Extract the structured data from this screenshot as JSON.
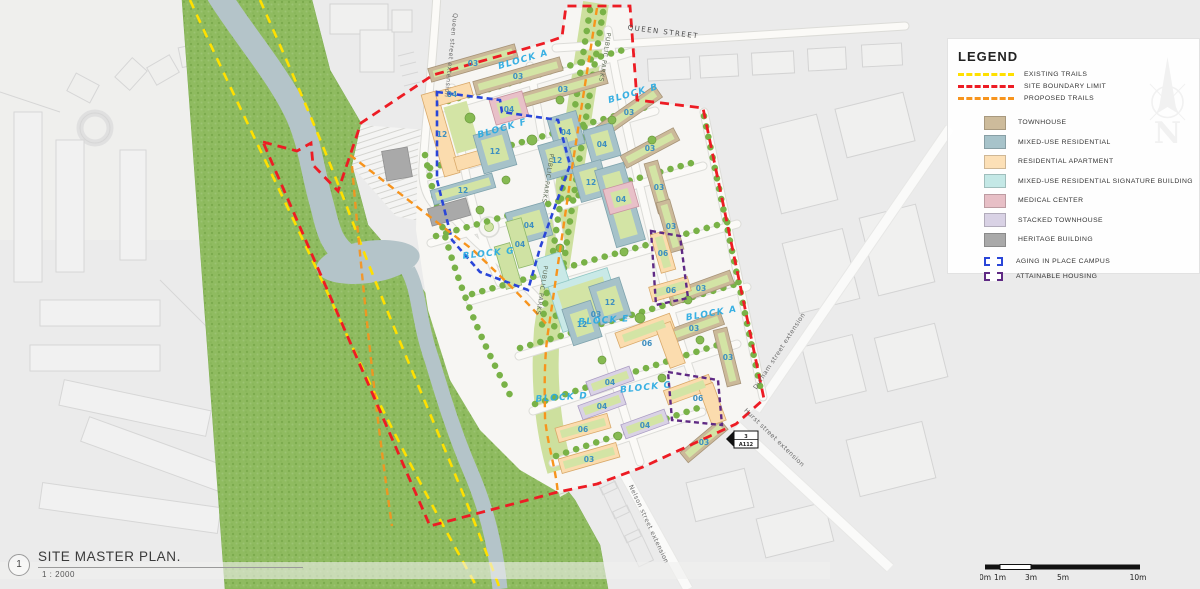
{
  "legend": {
    "title": "LEGEND",
    "line_items": [
      {
        "label": "EXISTING TRAILS",
        "color": "#ffe000"
      },
      {
        "label": "SITE BOUNDARY LIMIT",
        "color": "#ed1c24"
      },
      {
        "label": "PROPOSED TRAILS",
        "color": "#f7941d"
      }
    ],
    "swatch_items": [
      {
        "label": "TOWNHOUSE",
        "color": "#cdbb9b"
      },
      {
        "label": "MIXED-USE RESIDENTIAL",
        "color": "#a7c3ca"
      },
      {
        "label": "RESIDENTIAL APARTMENT",
        "color": "#fce0b7"
      },
      {
        "label": "MIXED-USE RESIDENTIAL SIGNATURE BUILDING",
        "color": "#c4e8e6"
      },
      {
        "label": "MEDICAL CENTER",
        "color": "#e7bfc6"
      },
      {
        "label": "STACKED TOWNHOUSE",
        "color": "#d9d2e5"
      },
      {
        "label": "HERITAGE BUILDING",
        "color": "#a9a9a9"
      }
    ],
    "outline_items": [
      {
        "label": "AGING IN PLACE CAMPUS",
        "color": "#2a46d8"
      },
      {
        "label": "ATTAINABLE HOUSING",
        "color": "#5f2a84"
      }
    ]
  },
  "north_label": "N",
  "title_block": {
    "drawing_number": "1",
    "title": "SITE MASTER PLAN.",
    "scale": "1 : 2000"
  },
  "scale_bar": {
    "labels": [
      "0m",
      "1m",
      "3m",
      "5m",
      "10m"
    ]
  },
  "map": {
    "street_labels": [
      "QUEEN STREET",
      "Queen street extension",
      "PUBLIC PARKS",
      "PUBLIC PARKS",
      "PUBLIC PARKS",
      "Durham street extension",
      "Hurst street extension",
      "Nelson street extension"
    ],
    "block_labels": [
      "BLOCK A",
      "BLOCK B",
      "BLOCK F",
      "BLOCK G",
      "BLOCK A",
      "BLOCK E",
      "BLOCK C",
      "BLOCK D"
    ],
    "parcels": [
      "03",
      "03",
      "03",
      "03",
      "03",
      "03",
      "03",
      "03",
      "03",
      "03",
      "03",
      "04",
      "12",
      "06",
      "06",
      "03",
      "06",
      "06",
      "06",
      "12",
      "04",
      "04",
      "12",
      "12",
      "12",
      "04",
      "12",
      "12",
      "03",
      "04",
      "04",
      "04",
      "04",
      "04",
      "04"
    ],
    "callout": {
      "number": "3",
      "sheet": "A112"
    },
    "colors": {
      "existing_trails": "#ffe000",
      "site_boundary_limit": "#ed1c24",
      "proposed_trails": "#f7941d",
      "aging_in_place_campus": "#2a46d8",
      "attainable_housing": "#5f2a84"
    }
  }
}
